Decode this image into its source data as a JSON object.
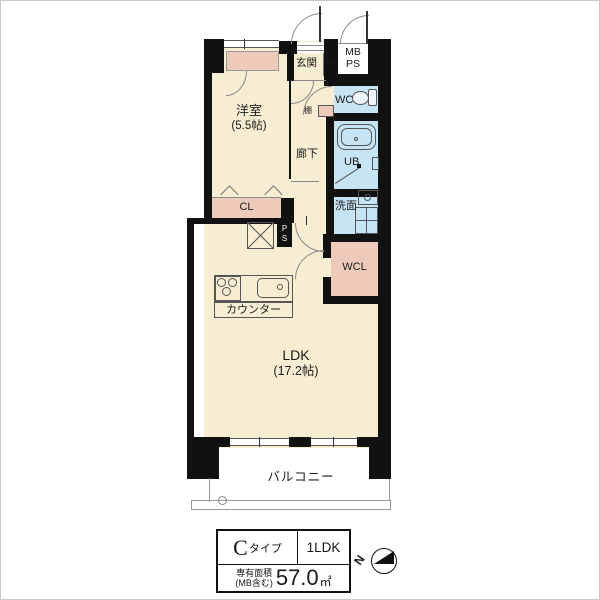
{
  "plan": {
    "rooms": {
      "yoshitsu": {
        "label": "洋室",
        "size": "(5.5帖)"
      },
      "genkan": {
        "label": "玄関"
      },
      "sb": {
        "label": "SB"
      },
      "mb": {
        "label": "MB"
      },
      "ps_top": {
        "label": "PS"
      },
      "wc": {
        "label": "WC"
      },
      "tana": {
        "label": "棚"
      },
      "rouka": {
        "label": "廊下"
      },
      "ub": {
        "label": "UB"
      },
      "senmen": {
        "label": "洗面"
      },
      "cl": {
        "label": "CL"
      },
      "wcl": {
        "label": "WCL"
      },
      "ps_shaft": {
        "label": "PS"
      },
      "counter": {
        "label": "カウンター"
      },
      "ldk": {
        "label": "LDK",
        "size": "(17.2帖)"
      },
      "balcony": {
        "label": "バルコニー"
      }
    }
  },
  "legend": {
    "type_letter": "C",
    "type_suffix": "タイプ",
    "layout": "1LDK",
    "area_title": "専有面積",
    "area_note": "(MB含む)",
    "area_value": "57.0",
    "area_unit": "㎡"
  },
  "compass": {
    "north": "N"
  },
  "colors": {
    "floor_cream": "#f6edd2",
    "closet_pink": "#eecabb",
    "wet_blue": "#c6e4f4",
    "wall_black": "#111111"
  }
}
